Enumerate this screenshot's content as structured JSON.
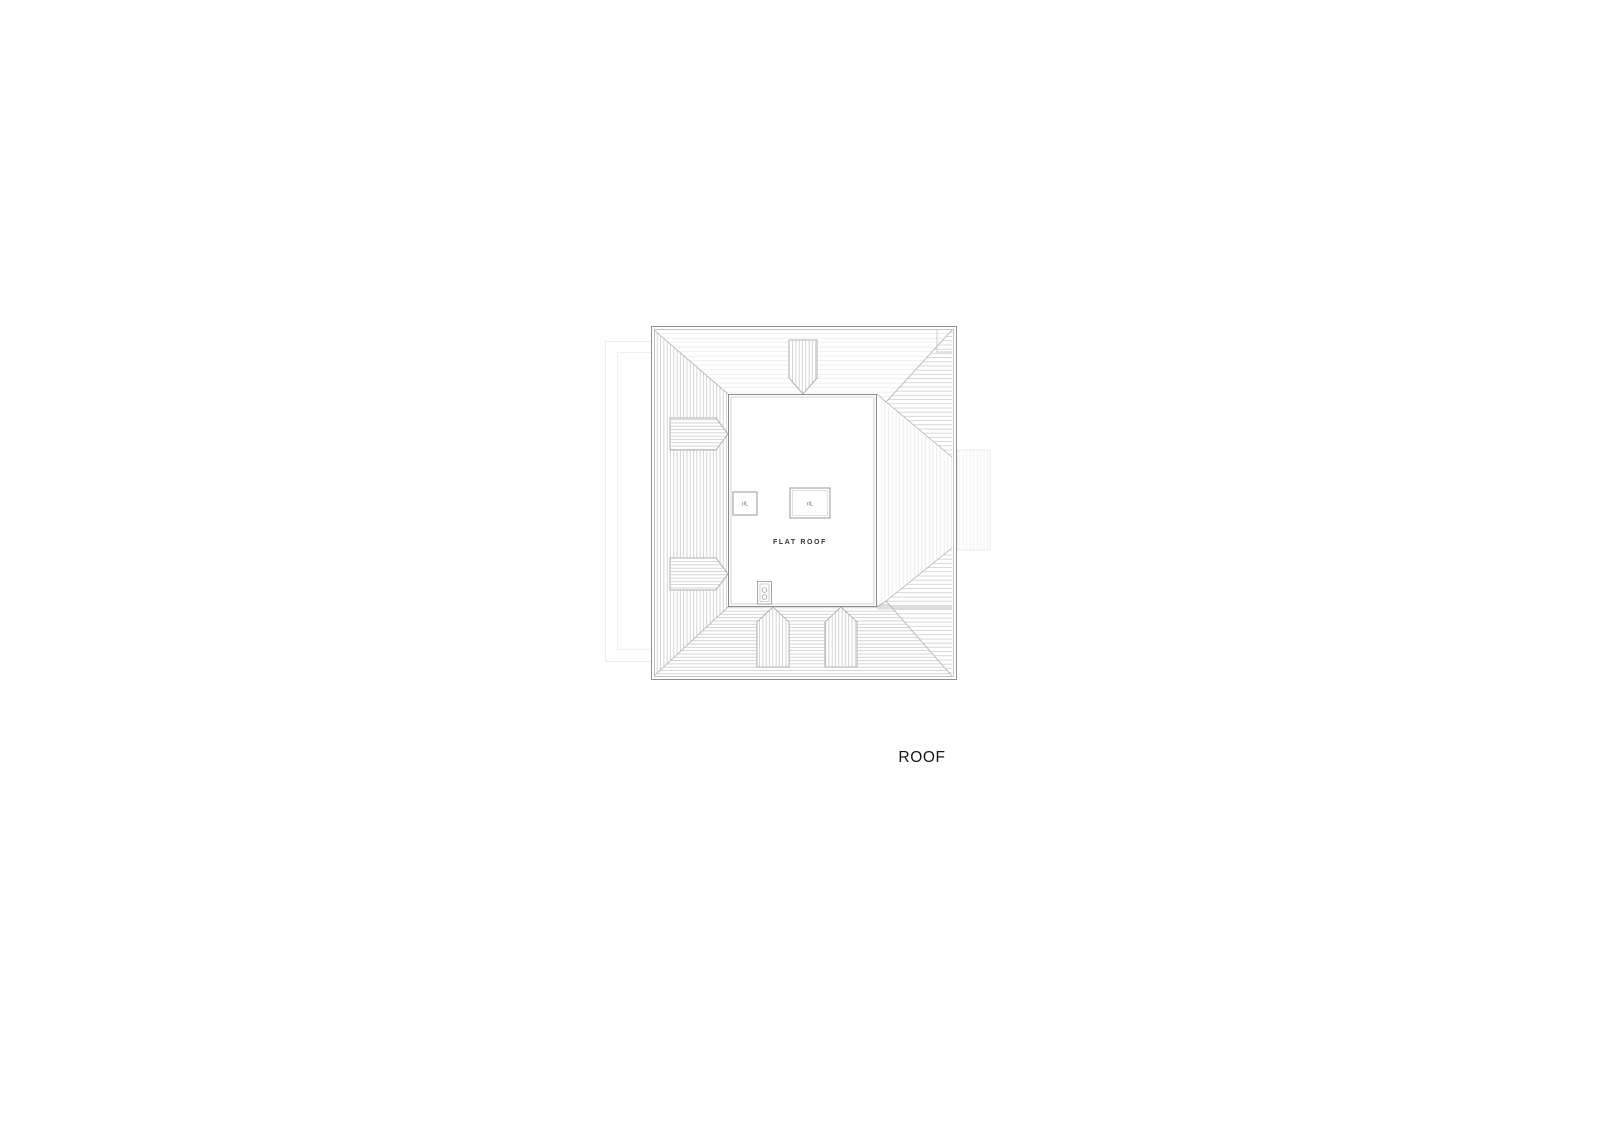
{
  "drawing": {
    "sheet_title": "ROOF",
    "flat_roof_label": "FLAT ROOF",
    "rooflights": {
      "small_label": "r/L",
      "large_label": "r/L"
    },
    "colors": {
      "background": "#ffffff",
      "outline": "#8f8f8f",
      "outline_light": "#ababab",
      "hip_line": "#b0b0b0",
      "hatch_dark": "#c3c3c3",
      "hatch_faint": "#e9e9e9",
      "hatch_mid": "#c9c9c9",
      "ghost_line": "#ececec",
      "label_text": "#333333",
      "title_text": "#161616"
    }
  }
}
